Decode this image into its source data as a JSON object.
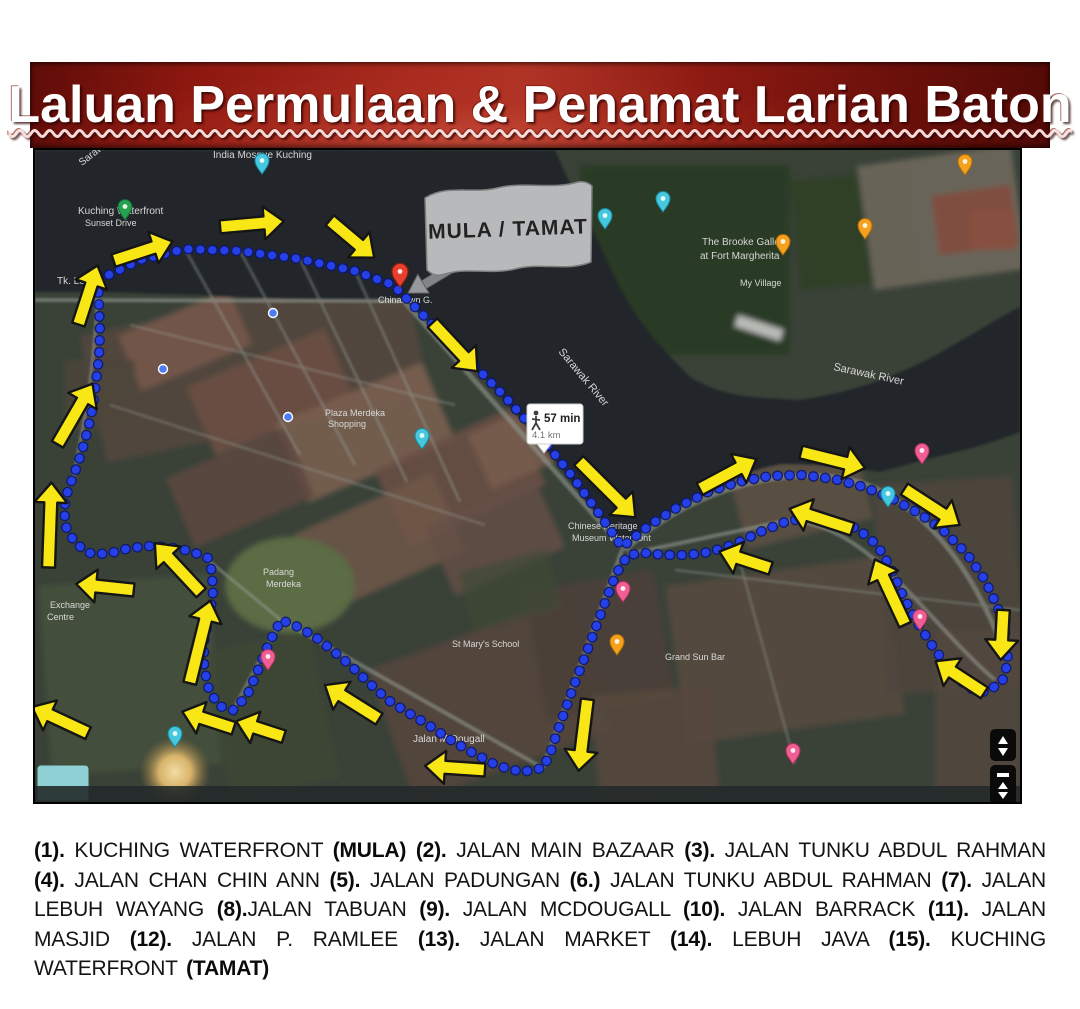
{
  "title": "Laluan Permulaan & Penamat Larian Baton",
  "map": {
    "flag_label": "MULA / TAMAT",
    "route_info": {
      "duration": "57 min",
      "distance": "4.1 km"
    },
    "colors": {
      "route_blue": "#2640e8",
      "route_blue_dark": "#0b1770",
      "arrow_yellow": "#f8e714",
      "arrow_outline": "#151515",
      "banner_red": "#9e1b14",
      "flag_grey": "#b8b9bb",
      "water": "#20262c"
    },
    "labels": [
      [
        "Sarawak",
        47,
        16,
        -38,
        10
      ],
      [
        "India Mosque Kuching",
        178,
        8,
        0,
        10
      ],
      [
        "Kuching Waterfront",
        43,
        64,
        0,
        10
      ],
      [
        "Sunset Drive",
        50,
        76,
        0,
        9
      ],
      [
        "Tk. Lebuh",
        22,
        134,
        0,
        10
      ],
      [
        "Chinatown G.",
        343,
        153,
        0,
        9
      ],
      [
        "The Brooke Gallery",
        667,
        95,
        0,
        10
      ],
      [
        "at Fort Margherita",
        665,
        109,
        0,
        10
      ],
      [
        "My Village",
        705,
        136,
        0,
        9
      ],
      [
        "Sarawak River",
        523,
        202,
        50,
        11
      ],
      [
        "Sarawak River",
        798,
        220,
        12,
        11
      ],
      [
        "Plaza Merdeka",
        290,
        266,
        0,
        9
      ],
      [
        "Shopping",
        293,
        277,
        0,
        9
      ],
      [
        "Chinese Heritage",
        533,
        379,
        0,
        9
      ],
      [
        "Museum Waterfront",
        537,
        391,
        0,
        9
      ],
      [
        "St Mary's School",
        417,
        497,
        0,
        9
      ],
      [
        "Padang",
        228,
        425,
        0,
        9
      ],
      [
        "Merdeka",
        231,
        437,
        0,
        9
      ],
      [
        "Exchange",
        15,
        458,
        0,
        9
      ],
      [
        "Centre",
        12,
        470,
        0,
        9
      ],
      [
        "Jalan M.Dougall",
        378,
        592,
        0,
        10
      ],
      [
        "Grand Sun Bar",
        630,
        510,
        0,
        9
      ]
    ],
    "pins": [
      [
        "green",
        90,
        70
      ],
      [
        "red",
        365,
        137
      ],
      [
        "cyan",
        227,
        24
      ],
      [
        "cyan",
        570,
        79
      ],
      [
        "cyan",
        628,
        62
      ],
      [
        "cyan",
        387,
        299
      ],
      [
        "cyan",
        853,
        357
      ],
      [
        "cyan",
        140,
        597
      ],
      [
        "pink",
        887,
        314
      ],
      [
        "pink",
        588,
        452
      ],
      [
        "pink",
        885,
        480
      ],
      [
        "pink",
        233,
        520
      ],
      [
        "pink",
        758,
        614
      ],
      [
        "orange",
        748,
        105
      ],
      [
        "orange",
        830,
        89
      ],
      [
        "orange",
        930,
        25
      ],
      [
        "orange",
        582,
        505
      ],
      [
        "blue",
        238,
        163
      ],
      [
        "blue",
        253,
        267
      ],
      [
        "blue",
        128,
        219
      ]
    ],
    "arrows": [
      [
        108,
        101,
        -18,
        62
      ],
      [
        217,
        74,
        -5,
        64
      ],
      [
        317,
        89,
        40,
        58
      ],
      [
        53,
        145,
        -72,
        62
      ],
      [
        40,
        264,
        -60,
        70
      ],
      [
        15,
        375,
        -88,
        85
      ],
      [
        70,
        437,
        186,
        58
      ],
      [
        143,
        418,
        -133,
        68
      ],
      [
        165,
        492,
        -76,
        85
      ],
      [
        173,
        570,
        198,
        54
      ],
      [
        225,
        579,
        198,
        50
      ],
      [
        25,
        570,
        205,
        62
      ],
      [
        317,
        552,
        -148,
        64
      ],
      [
        420,
        618,
        184,
        60
      ],
      [
        548,
        585,
        97,
        72
      ],
      [
        420,
        197,
        47,
        66
      ],
      [
        572,
        339,
        45,
        80
      ],
      [
        693,
        324,
        -28,
        64
      ],
      [
        798,
        310,
        14,
        66
      ],
      [
        897,
        357,
        33,
        66
      ],
      [
        967,
        485,
        93,
        50
      ],
      [
        925,
        527,
        -147,
        58
      ],
      [
        855,
        442,
        -115,
        72
      ],
      [
        786,
        369,
        198,
        66
      ],
      [
        710,
        410,
        198,
        54
      ]
    ],
    "route": [
      [
        63,
        130
      ],
      [
        105,
        110
      ],
      [
        150,
        99
      ],
      [
        205,
        101
      ],
      [
        265,
        109
      ],
      [
        320,
        121
      ],
      [
        358,
        135
      ],
      [
        372,
        149
      ],
      [
        405,
        182
      ],
      [
        438,
        214
      ],
      [
        471,
        248
      ],
      [
        505,
        286
      ],
      [
        537,
        326
      ],
      [
        565,
        365
      ],
      [
        587,
        397
      ],
      [
        615,
        375
      ],
      [
        643,
        357
      ],
      [
        673,
        342
      ],
      [
        703,
        332
      ],
      [
        735,
        326
      ],
      [
        767,
        325
      ],
      [
        799,
        329
      ],
      [
        829,
        337
      ],
      [
        858,
        349
      ],
      [
        885,
        364
      ],
      [
        910,
        382
      ],
      [
        932,
        404
      ],
      [
        950,
        430
      ],
      [
        963,
        458
      ],
      [
        971,
        486
      ],
      [
        973,
        512
      ],
      [
        967,
        532
      ],
      [
        951,
        542
      ],
      [
        933,
        538
      ],
      [
        915,
        520
      ],
      [
        898,
        497
      ],
      [
        882,
        472
      ],
      [
        868,
        446
      ],
      [
        856,
        418
      ],
      [
        842,
        395
      ],
      [
        823,
        379
      ],
      [
        800,
        370
      ],
      [
        775,
        367
      ],
      [
        750,
        372
      ],
      [
        725,
        382
      ],
      [
        700,
        394
      ],
      [
        675,
        402
      ],
      [
        653,
        405
      ],
      [
        630,
        405
      ],
      [
        610,
        403
      ],
      [
        593,
        405
      ],
      [
        581,
        424
      ],
      [
        571,
        450
      ],
      [
        561,
        477
      ],
      [
        551,
        504
      ],
      [
        541,
        530
      ],
      [
        532,
        555
      ],
      [
        523,
        580
      ],
      [
        515,
        604
      ],
      [
        508,
        618
      ],
      [
        487,
        622
      ],
      [
        463,
        616
      ],
      [
        438,
        603
      ],
      [
        414,
        589
      ],
      [
        392,
        574
      ],
      [
        372,
        562
      ],
      [
        353,
        550
      ],
      [
        333,
        532
      ],
      [
        315,
        515
      ],
      [
        297,
        500
      ],
      [
        279,
        486
      ],
      [
        261,
        476
      ],
      [
        246,
        470
      ],
      [
        234,
        493
      ],
      [
        223,
        520
      ],
      [
        212,
        546
      ],
      [
        198,
        560
      ],
      [
        184,
        556
      ],
      [
        174,
        540
      ],
      [
        169,
        517
      ],
      [
        169,
        492
      ],
      [
        174,
        467
      ],
      [
        178,
        445
      ],
      [
        177,
        422
      ],
      [
        173,
        408
      ],
      [
        155,
        401
      ],
      [
        133,
        397
      ],
      [
        111,
        396
      ],
      [
        91,
        399
      ],
      [
        72,
        404
      ],
      [
        54,
        403
      ],
      [
        40,
        393
      ],
      [
        31,
        377
      ],
      [
        29,
        359
      ],
      [
        33,
        340
      ],
      [
        40,
        322
      ],
      [
        47,
        301
      ],
      [
        53,
        279
      ],
      [
        58,
        256
      ],
      [
        61,
        232
      ],
      [
        64,
        207
      ],
      [
        65,
        181
      ],
      [
        64,
        155
      ],
      [
        63,
        132
      ]
    ]
  },
  "legend": {
    "parts": [
      {
        "t": "(1).",
        "b": true
      },
      {
        "t": " KUCHING WATERFRONT "
      },
      {
        "t": "(MULA)",
        "b": true
      },
      {
        "t": " "
      },
      {
        "t": "(2).",
        "b": true
      },
      {
        "t": " JALAN MAIN BAZAAR "
      },
      {
        "t": "(3).",
        "b": true
      },
      {
        "t": " JALAN TUNKU ABDUL RAHMAN "
      },
      {
        "t": "(4).",
        "b": true
      },
      {
        "t": " JALAN CHAN CHIN ANN "
      },
      {
        "t": "(5).",
        "b": true
      },
      {
        "t": " JALAN PADUNGAN "
      },
      {
        "t": "(6.)",
        "b": true
      },
      {
        "t": " JALAN TUNKU ABDUL RAHMAN "
      },
      {
        "t": "(7).",
        "b": true
      },
      {
        "t": " JALAN LEBUH WAYANG "
      },
      {
        "t": "(8).",
        "b": true
      },
      {
        "t": "JALAN TABUAN "
      },
      {
        "t": "(9).",
        "b": true
      },
      {
        "t": " JALAN MCDOUGALL "
      },
      {
        "t": "(10).",
        "b": true
      },
      {
        "t": " JALAN BARRACK "
      },
      {
        "t": "(11).",
        "b": true
      },
      {
        "t": " JALAN MASJID "
      },
      {
        "t": "(12).",
        "b": true
      },
      {
        "t": " JALAN P. RAMLEE "
      },
      {
        "t": "(13).",
        "b": true
      },
      {
        "t": " JALAN MARKET "
      },
      {
        "t": "(14).",
        "b": true
      },
      {
        "t": " LEBUH JAVA "
      },
      {
        "t": "(15).",
        "b": true
      },
      {
        "t": " KUCHING WATERFRONT "
      },
      {
        "t": "(TAMAT)",
        "b": true
      }
    ]
  }
}
